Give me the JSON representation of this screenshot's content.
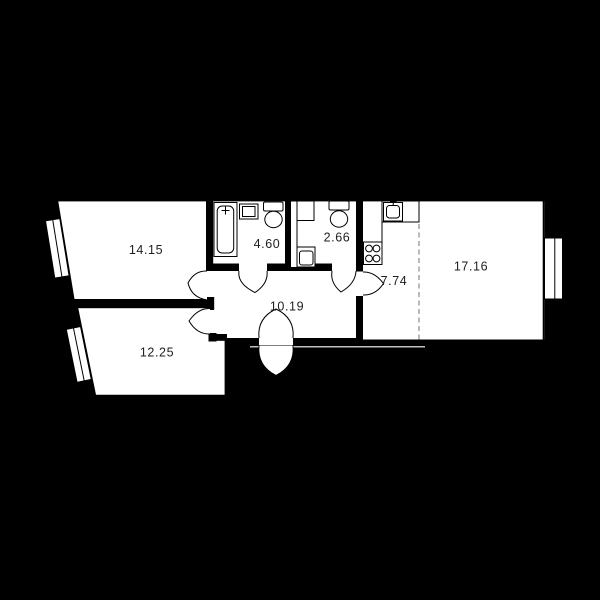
{
  "colors": {
    "background": "#000000",
    "floor": "#ffffff",
    "walls": "#000000",
    "zone_divider_dashed": "#8c8c8c",
    "label_text": "#1e1e1e"
  },
  "floorplan": {
    "type": "apartment-floor-plan",
    "rooms": {
      "bedroom_top_left": {
        "area": "14.15"
      },
      "bathroom": {
        "area": "4.60"
      },
      "toilet": {
        "area": "2.66"
      },
      "kitchen": {
        "area": "7.74"
      },
      "living_room": {
        "area": "17.16"
      },
      "hallway": {
        "area": "10.19"
      },
      "bedroom_bottom_left": {
        "area": "12.25"
      }
    }
  }
}
